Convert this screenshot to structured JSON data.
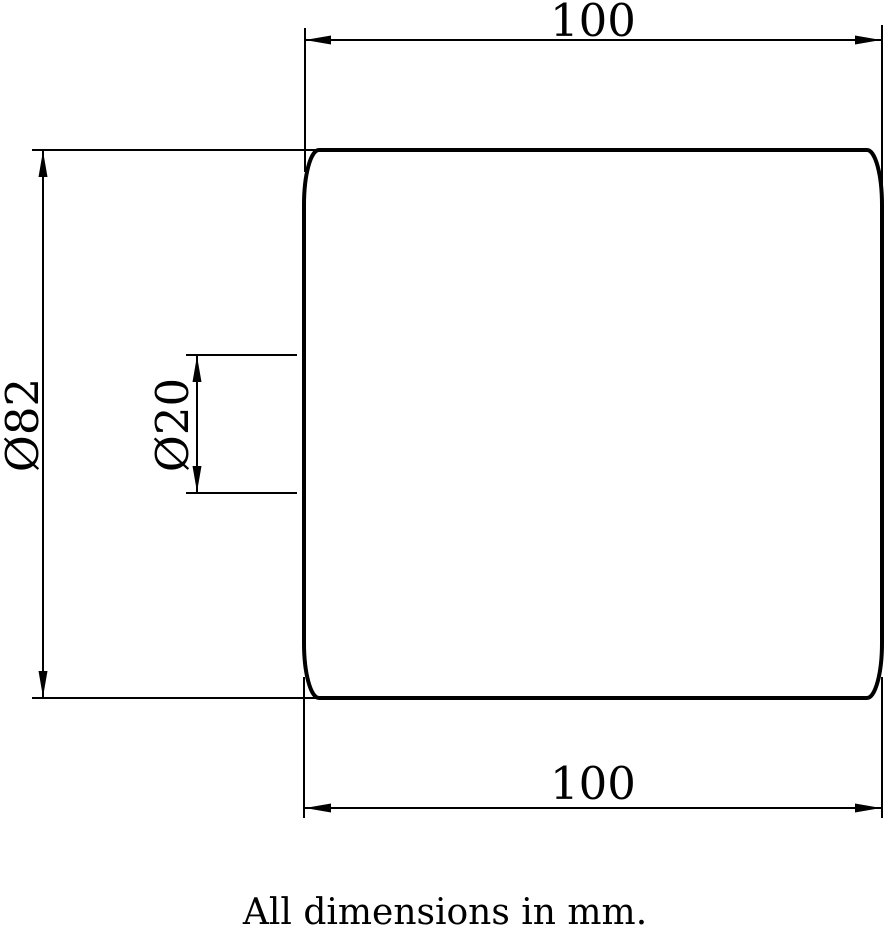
{
  "drawing": {
    "note": "All dimensions in mm.",
    "colors": {
      "line": "#000000",
      "background": "#ffffff"
    },
    "dimensions": {
      "top_width": {
        "label": "100"
      },
      "bottom_width": {
        "label": "100"
      },
      "outer_diameter": {
        "label": "Ø82"
      },
      "bore_diameter": {
        "label": "Ø20"
      }
    }
  }
}
